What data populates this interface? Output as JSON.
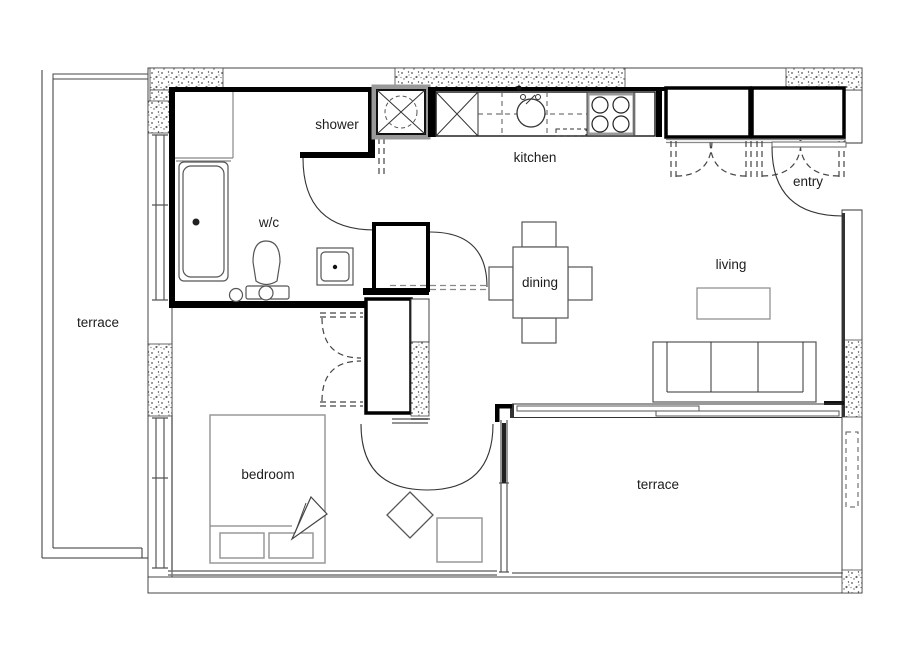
{
  "title": "apartment floor plan",
  "colors": {
    "background": "#ffffff",
    "wall": "#000000",
    "line": "#333333",
    "window": "#888888",
    "text": "#1c1c1c"
  },
  "rooms": {
    "terrace_left": {
      "label": "terrace"
    },
    "shower": {
      "label": "shower"
    },
    "wc": {
      "label": "w/c"
    },
    "kitchen": {
      "label": "kitchen"
    },
    "entry": {
      "label": "entry"
    },
    "dining": {
      "label": "dining"
    },
    "living": {
      "label": "living"
    },
    "bedroom": {
      "label": "bedroom"
    },
    "terrace_bottom": {
      "label": "terrace"
    }
  }
}
